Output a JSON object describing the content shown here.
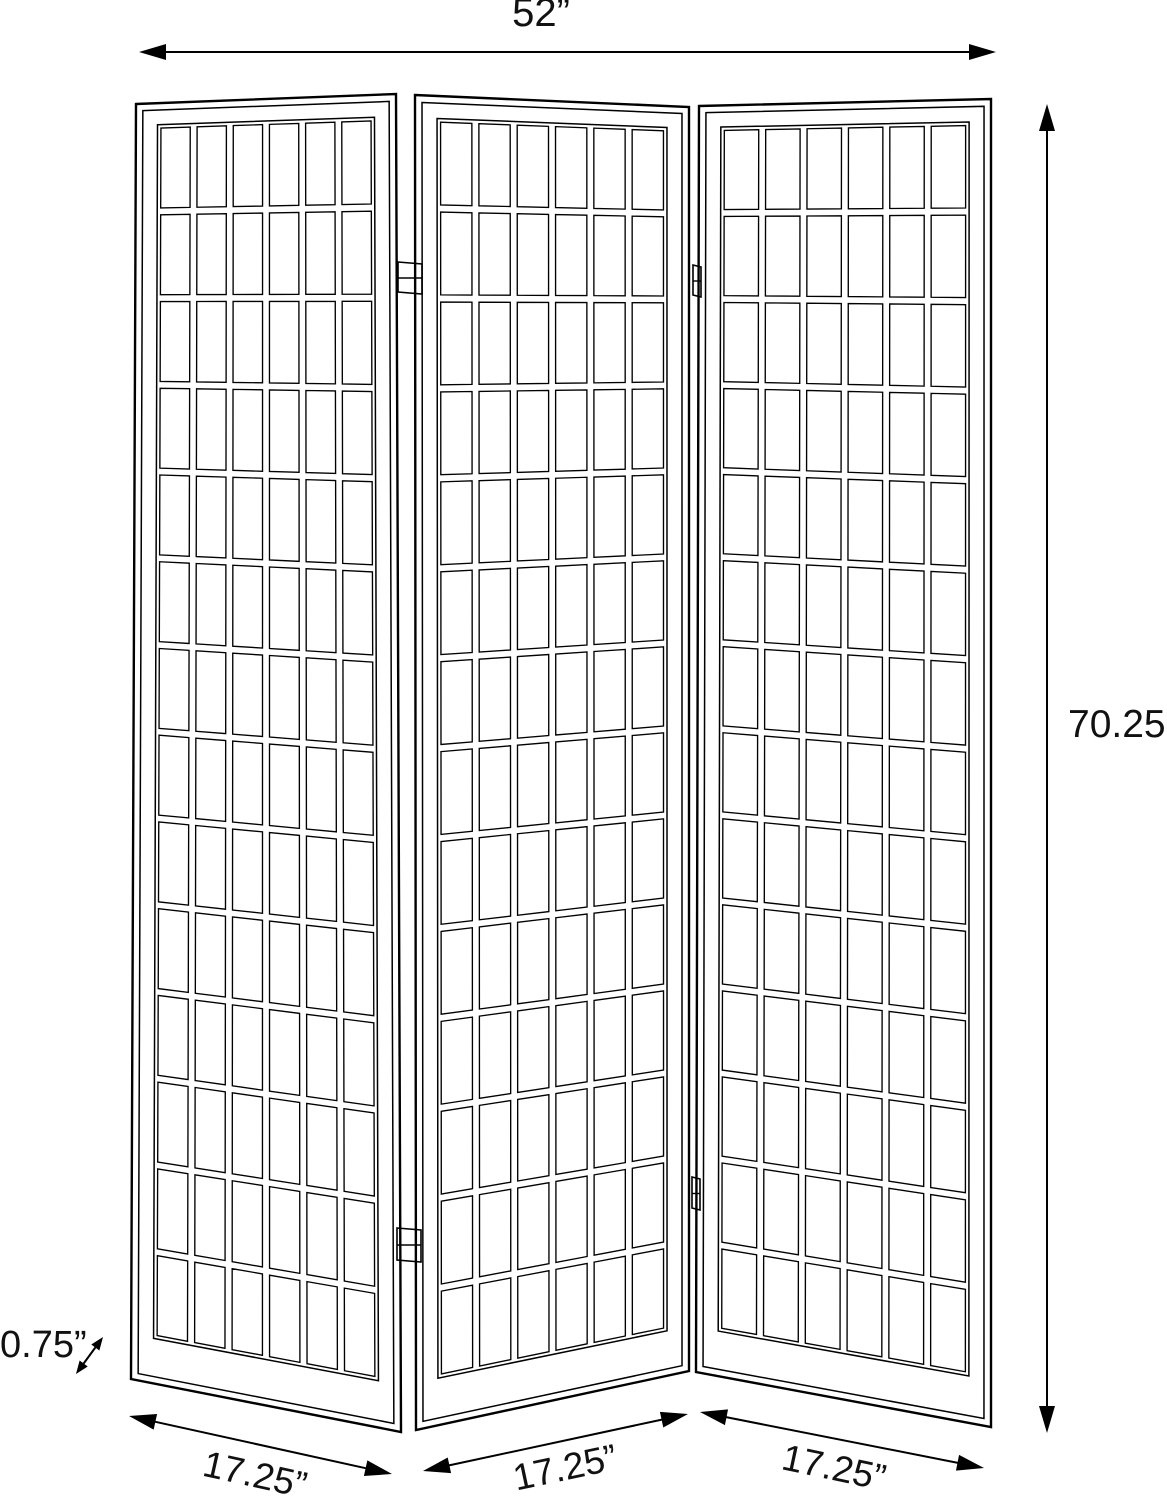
{
  "page": {
    "background": "#ffffff",
    "line_color": "#000000"
  },
  "diagram": {
    "kind": "product-dimension-drawing",
    "product": "3-panel folding room divider screen (shoji style window-pane grid)",
    "panel_count": 3,
    "grid_columns": 6,
    "grid_rows": 14,
    "dimensions": {
      "total_width": "52”",
      "height": "70.25”",
      "frame_thickness": "0.75”",
      "panel_widths": [
        "17.25”",
        "17.25”",
        "17.25”"
      ]
    }
  }
}
